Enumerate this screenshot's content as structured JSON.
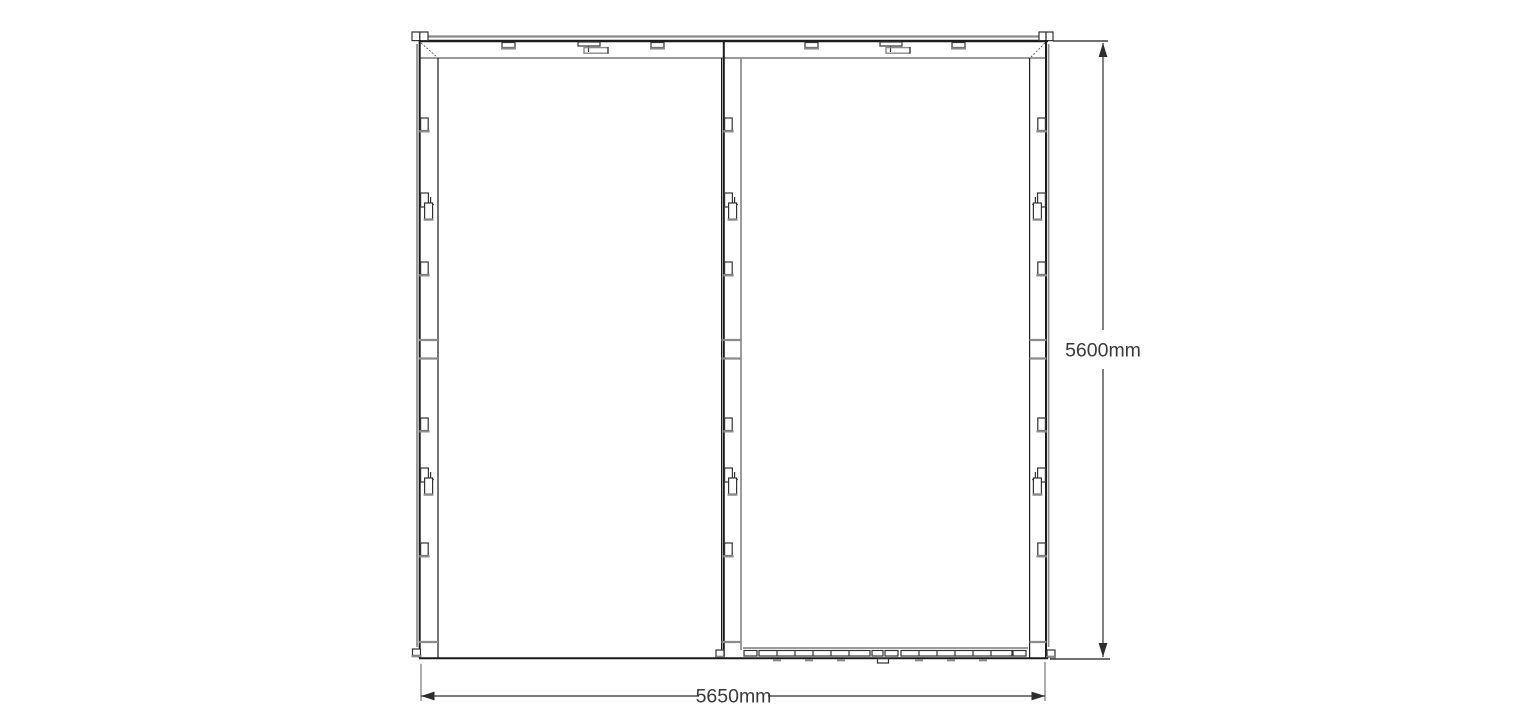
{
  "drawing": {
    "dimension_labels": {
      "width": "5650mm",
      "height": "5600mm"
    },
    "colors": {
      "background": "#ffffff",
      "primary_line": "#1c1c1c",
      "secondary_line": "#8b8b8b",
      "dimension_line": "#2e2e2e",
      "label_text": "#3a3a3a"
    }
  }
}
